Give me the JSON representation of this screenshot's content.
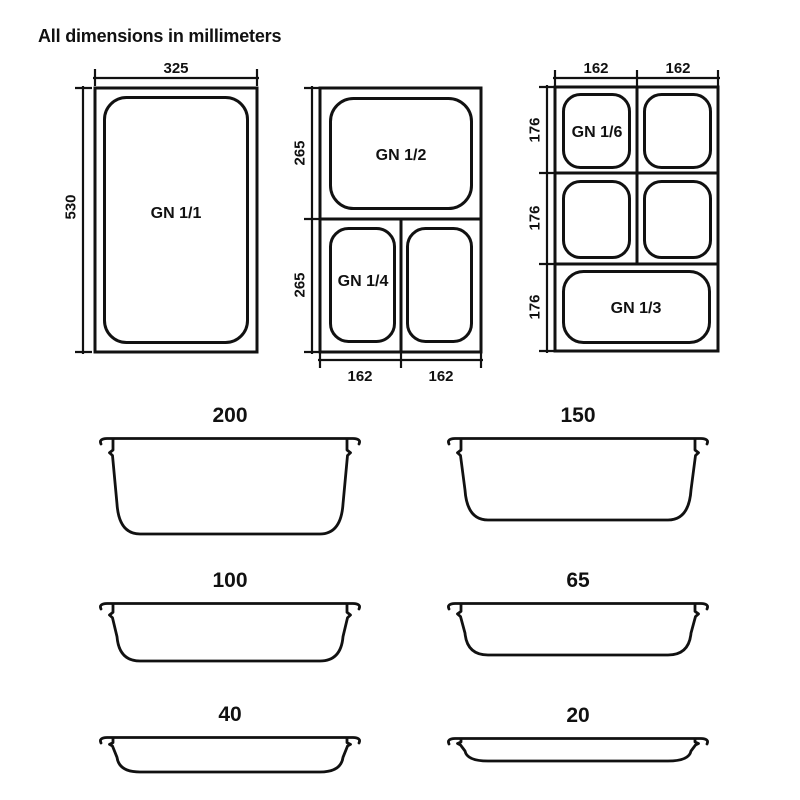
{
  "title": "All dimensions in millimeters",
  "colors": {
    "ink": "#111111",
    "background": "#ffffff"
  },
  "top_views": {
    "gn_1_1": {
      "pan_label": "GN 1/1",
      "width_label": "325",
      "height_label": "530"
    },
    "gn_half_quarter": {
      "compartments": {
        "top": "GN 1/2",
        "bottom_left": "GN 1/4"
      },
      "left_labels": [
        "265",
        "265"
      ],
      "bottom_labels": [
        "162",
        "162"
      ]
    },
    "gn_sixth_third": {
      "compartments": {
        "top_left": "GN 1/6",
        "bottom": "GN 1/3"
      },
      "top_labels": [
        "162",
        "162"
      ],
      "left_labels": [
        "176",
        "176",
        "176"
      ]
    }
  },
  "profiles": [
    {
      "label": "200",
      "depth_px": 96
    },
    {
      "label": "150",
      "depth_px": 82
    },
    {
      "label": "100",
      "depth_px": 58
    },
    {
      "label": "65",
      "depth_px": 52
    },
    {
      "label": "40",
      "depth_px": 35
    },
    {
      "label": "20",
      "depth_px": 23
    }
  ]
}
